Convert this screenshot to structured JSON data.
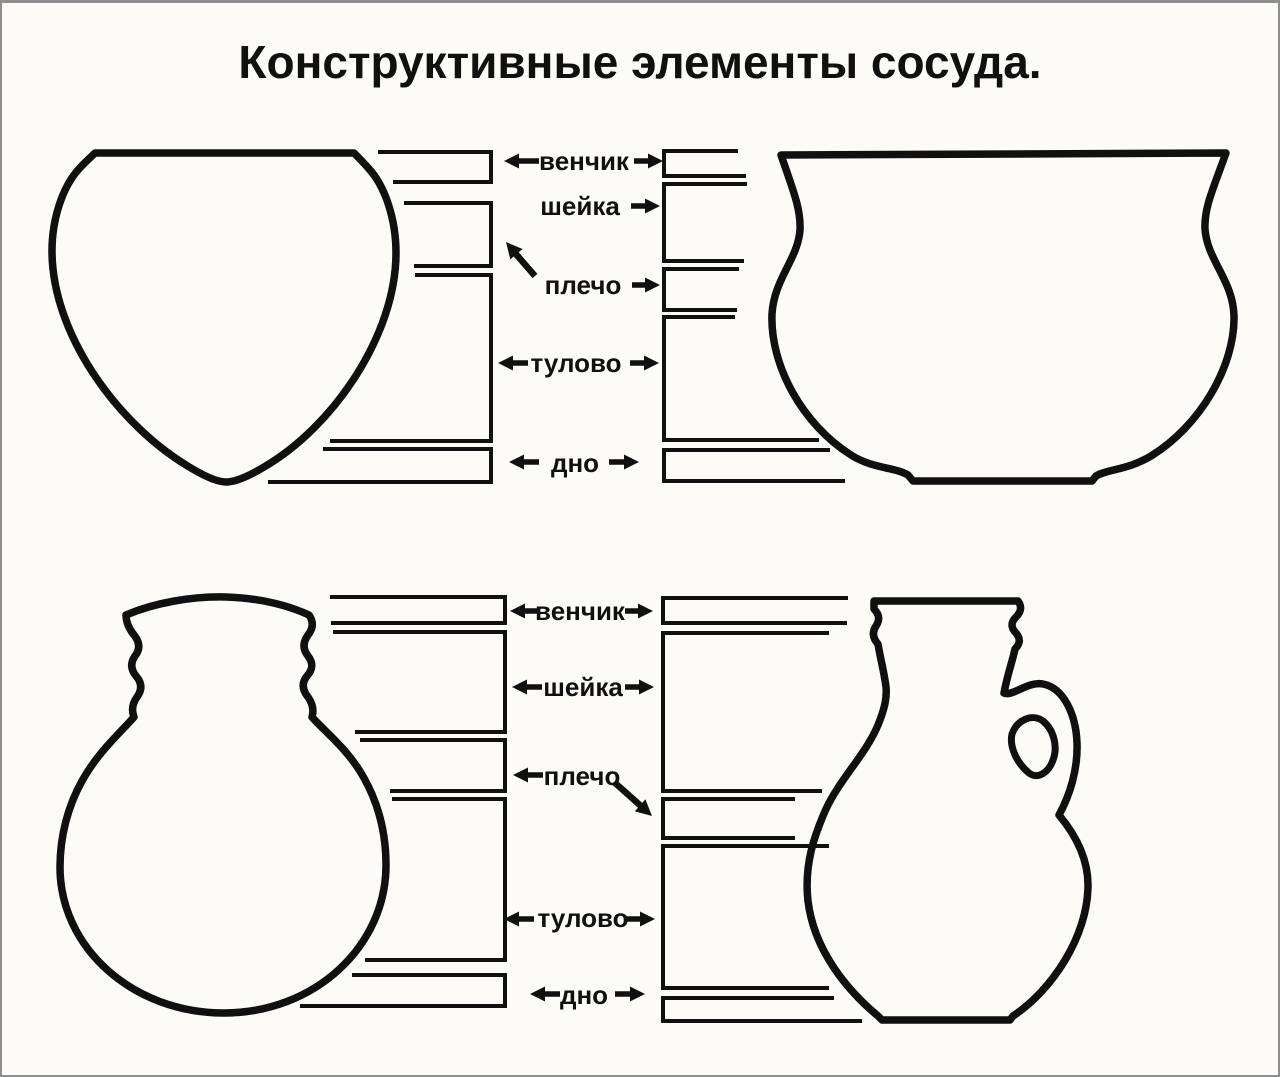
{
  "title": "Конструктивные элементы сосуда.",
  "zone_labels": {
    "rim": "венчик",
    "neck": "шейка",
    "shoulder": "плечо",
    "body": "тулово",
    "base": "дно"
  },
  "icons": {
    "arrow_left": "◄",
    "arrow_right": "►",
    "arrow_up_left": "↖",
    "arrow_down_right": "↘"
  },
  "colors": {
    "ink": "#101010",
    "paper": "#fcfbf8",
    "frame": "#8f8f8f"
  }
}
